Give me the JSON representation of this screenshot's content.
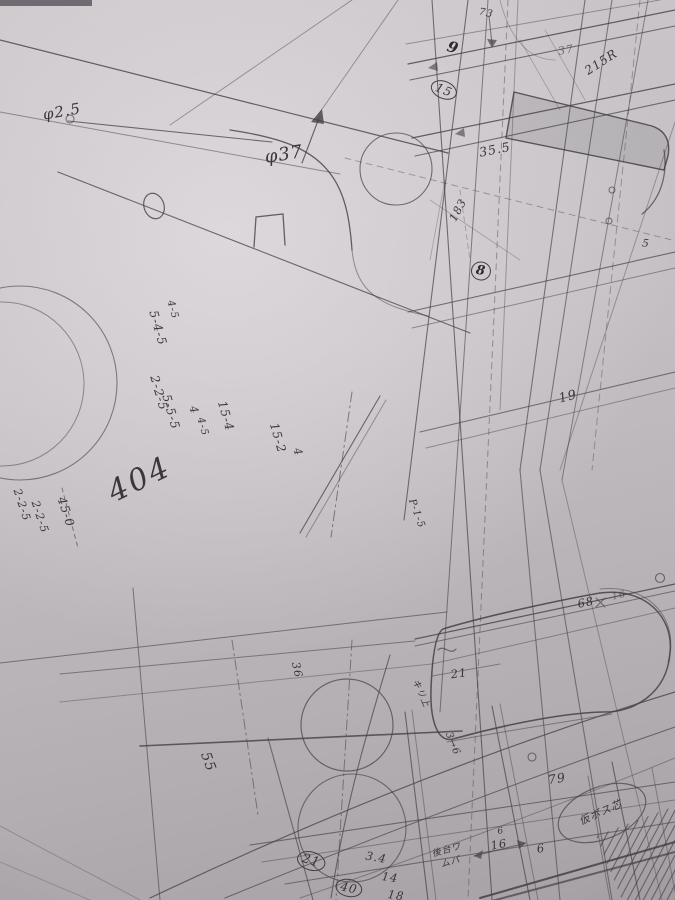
{
  "palette": {
    "paper_light": "#dedade",
    "paper_mid": "#c4c0c4",
    "paper_dark": "#a5a1a5",
    "ink": "#464046",
    "ink_bold": "#2e282e"
  },
  "annotations": {
    "phi25": "φ2.5",
    "phi37": "φ37",
    "dim73": "73",
    "mark9": "9",
    "circ15": "15",
    "dim355": "35.5",
    "dim37": "37",
    "dim215r": "215R",
    "dim183": "183",
    "mark8": "8",
    "dim19": "19",
    "col545": "5-4-5",
    "col45": "4-5",
    "col225": "2-2-5",
    "col555": "5-5-5",
    "col4": "4",
    "col45b": "4-5",
    "col154": "15-4",
    "col152": "15-2",
    "col4b": "4",
    "num404": "404",
    "edge225": "2-2-5",
    "edge225b": "2-2-5",
    "edge450": "45-0",
    "num55": "55",
    "p15": "P-1-5",
    "num36": "36",
    "kiri": "キリ上",
    "seq36": "3→6",
    "num68": "68",
    "xmark": "×",
    "num16r": "16",
    "num21": "21",
    "num79": "79",
    "boss": "仮ボス芯",
    "c21": "21",
    "num34": "3.4",
    "c40": "40",
    "num14": "14",
    "num18": "18",
    "rear1": "後台ワ",
    "rear2": "ムパ",
    "num16": "16",
    "num6a": "6",
    "num6b": "6",
    "num5": "5"
  }
}
